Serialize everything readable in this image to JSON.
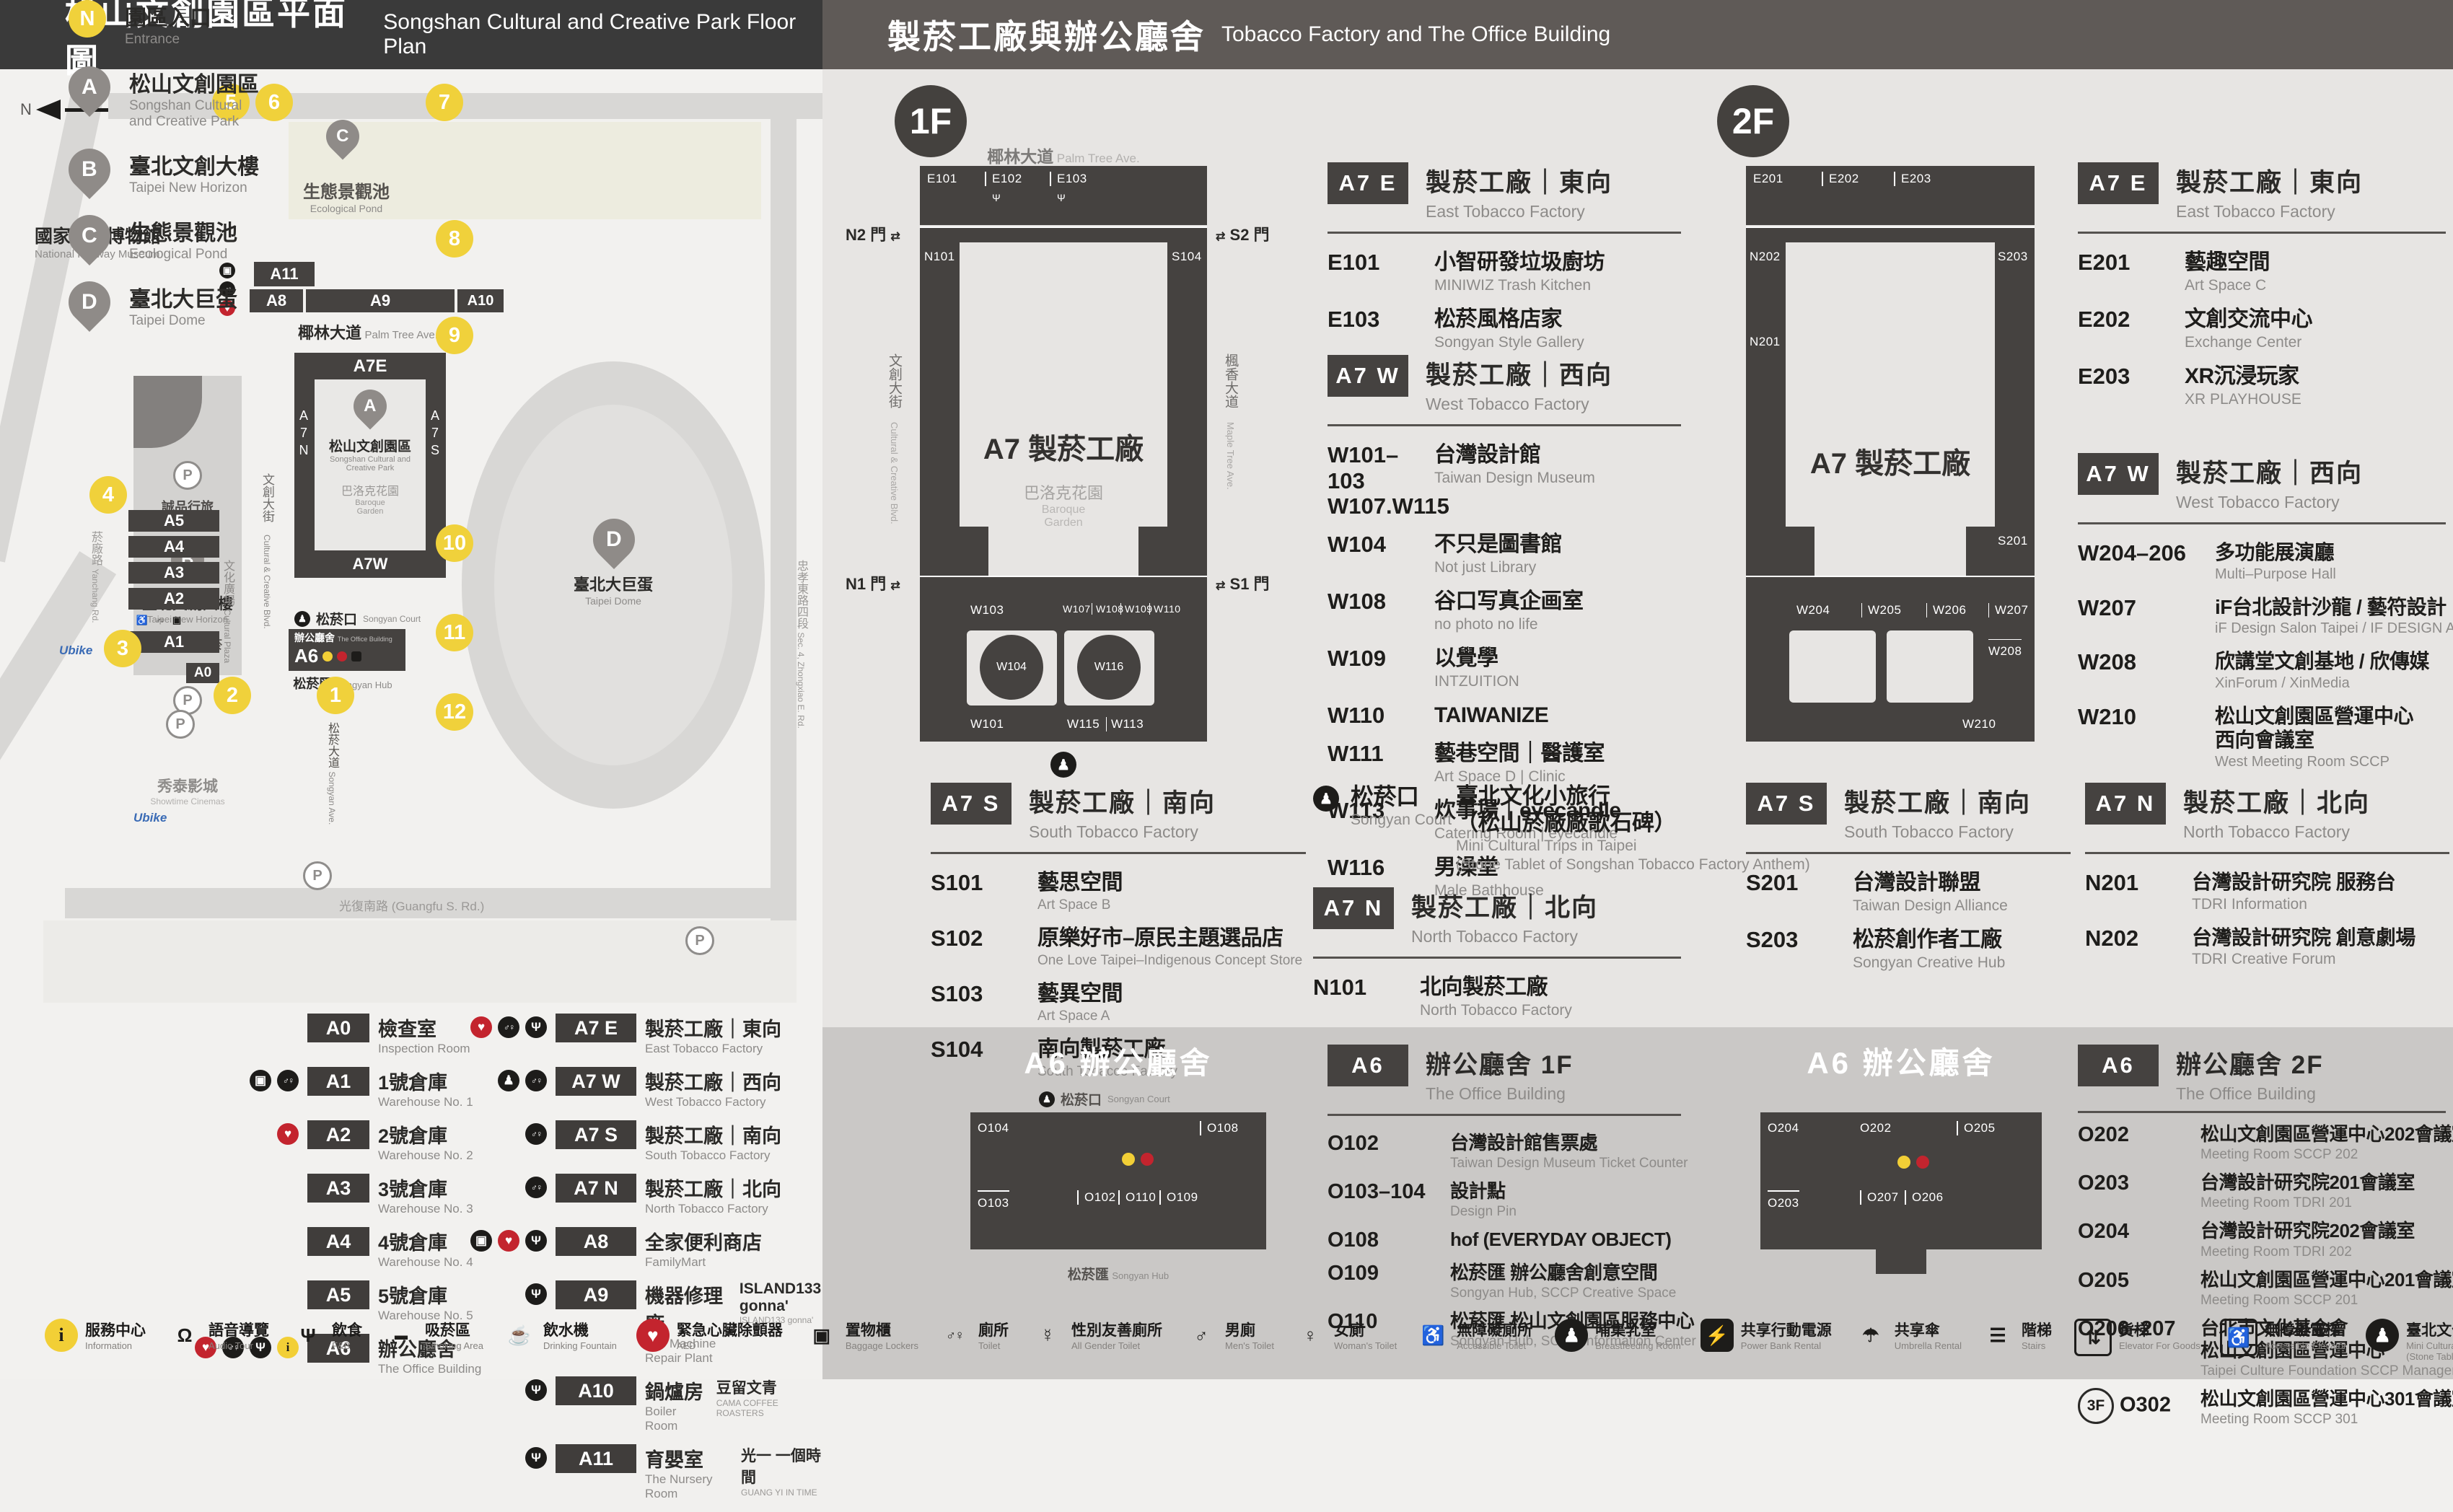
{
  "left": {
    "header": {
      "title_zh": "松山文創園區平面圖",
      "title_en": "Songshan Cultural and Creative Park Floor Plan"
    },
    "map": {
      "north": "N",
      "railway_zh": "國家鐵道博物館",
      "railway_en": "National Railway Museum",
      "pond_pin": "C",
      "pond_zh": "生態景觀池",
      "pond_en": "Ecological Pond",
      "palm_zh": "椰林大道",
      "palm_en": "Palm Tree Ave.",
      "a11": "A11",
      "a8": "A8",
      "a9": "A9",
      "a10": "A10",
      "b_pin": "B",
      "b_zh": "臺北文創大樓",
      "b_en": "Taipei New Horizon",
      "hotel_zh": "誠品行旅",
      "store_zh": "誠品生活松菸",
      "plaza_zh": "文化廣場",
      "plaza_en": "Cultural Plaza",
      "ccb_zh": "文創大街",
      "ccb_en": "Cultural & Creative Blvd.",
      "a7e": "A7E",
      "a7w": "A7W",
      "a7n": "A7N",
      "a7s": "A7S",
      "park_pin": "A",
      "park_zh": "松山文創園區",
      "park_en1": "Songshan Cultural and",
      "park_en2": "Creative Park",
      "baroque_zh": "巴洛克花園",
      "baroque_en1": "Baroque",
      "baroque_en2": "Garden",
      "court_zh": "松菸口",
      "court_en": "Songyan Court",
      "office_zh": "辦公廳舍",
      "office_en": "The Office Building",
      "a6": "A6",
      "hub_zh": "松菸匯",
      "hub_en": "Songyan Hub",
      "dome_pin": "D",
      "dome_zh": "臺北大巨蛋",
      "dome_en": "Taipei Dome",
      "a5": "A5",
      "a4": "A4",
      "a3": "A3",
      "a2": "A2",
      "a1": "A1",
      "a0": "A0",
      "yanchang_zh": "菸廠路",
      "yanchang_en": "Yanchang Rd.",
      "cinema_zh": "秀泰影城",
      "cinema_en": "Showtime Cinemas",
      "songyanave_zh": "松菸大道",
      "songyanave_en": "Songyan Ave.",
      "guangfu": "光復南路 (Guangfu S. Rd.)",
      "zhongxiao_zh": "忠孝東路四段",
      "zhongxiao_en": "Sec. 4, Zhongxiao E. Rd.",
      "ubike": "Ubike",
      "parking": "P",
      "numbers": [
        "1",
        "2",
        "3",
        "4",
        "5",
        "6",
        "7",
        "8",
        "9",
        "10",
        "11",
        "12"
      ]
    },
    "legend_places": [
      {
        "badge": "N",
        "style": "ynum",
        "zh": "園區入口",
        "en1": "Entrance",
        "en2": ""
      },
      {
        "badge": "A",
        "style": "pin",
        "zh": "松山文創園區",
        "en1": "Songshan Cultural",
        "en2": "and Creative Park"
      },
      {
        "badge": "B",
        "style": "pin",
        "zh": "臺北文創大樓",
        "en1": "Taipei New Horizon",
        "en2": ""
      },
      {
        "badge": "C",
        "style": "pin",
        "zh": "生態景觀池",
        "en1": "Ecological Pond",
        "en2": ""
      },
      {
        "badge": "D",
        "style": "pin",
        "zh": "臺北大巨蛋",
        "en1": "Taipei Dome",
        "en2": ""
      }
    ],
    "legend_buildings": [
      {
        "id": "A0",
        "zh": "檢查室",
        "en": "Inspection Room",
        "icons": []
      },
      {
        "id": "A1",
        "zh": "1號倉庫",
        "en": "Warehouse No. 1",
        "icons": [
          "locker-icon",
          "toilet-icon"
        ]
      },
      {
        "id": "A2",
        "zh": "2號倉庫",
        "en": "Warehouse No. 2",
        "icons": [
          "aed-icon"
        ]
      },
      {
        "id": "A3",
        "zh": "3號倉庫",
        "en": "Warehouse No. 3",
        "icons": []
      },
      {
        "id": "A4",
        "zh": "4號倉庫",
        "en": "Warehouse No. 4",
        "icons": []
      },
      {
        "id": "A5",
        "zh": "5號倉庫",
        "en": "Warehouse No. 5",
        "icons": []
      },
      {
        "id": "A6",
        "zh": "辦公廳舍",
        "en": "The Office Building",
        "icons": [
          "aed-icon",
          "toilet-icon",
          "fnb-icon",
          "info-icon"
        ]
      }
    ],
    "legend_factory": [
      {
        "id": "A7 E",
        "zh": "製菸工廠｜東向",
        "en": "East Tobacco Factory",
        "icons": [
          "aed-icon",
          "toilet-icon",
          "fnb-icon"
        ]
      },
      {
        "id": "A7 W",
        "zh": "製菸工廠｜西向",
        "en": "West Tobacco Factory",
        "icons": [
          "breastfeeding-icon",
          "toilet-icon"
        ]
      },
      {
        "id": "A7 S",
        "zh": "製菸工廠｜南向",
        "en": "South Tobacco Factory",
        "icons": [
          "toilet-icon"
        ]
      },
      {
        "id": "A7 N",
        "zh": "製菸工廠｜北向",
        "en": "North Tobacco Factory",
        "icons": [
          "toilet-icon"
        ]
      },
      {
        "id": "A8",
        "zh": "全家便利商店",
        "en": "FamilyMart",
        "icons": [
          "locker-icon",
          "aed-icon",
          "fnb-icon"
        ]
      },
      {
        "id": "A9",
        "zh": "機器修理廠",
        "en": "The Machine Repair Plant",
        "extra_zh": "ISLAND133 gonna'",
        "extra_en": "ISLAND133 gonna'",
        "icons": [
          "fnb-icon"
        ]
      },
      {
        "id": "A10",
        "zh": "鍋爐房",
        "en": "Boiler Room",
        "extra_zh": "豆留文青",
        "extra_en": "CAMA COFFEE ROASTERS",
        "icons": [
          "fnb-icon"
        ]
      },
      {
        "id": "A11",
        "zh": "育嬰室",
        "en": "The Nursery Room",
        "extra_zh": "光一 一個時間",
        "extra_en": "GUANG YI IN TIME",
        "icons": [
          "fnb-icon"
        ]
      }
    ]
  },
  "right": {
    "header": {
      "title_zh": "製菸工廠與辦公廳舍",
      "title_en": "Tobacco Factory and The Office Building"
    },
    "floor1": {
      "label": "1F",
      "plan": {
        "street_top_zh": "椰林大道",
        "street_top_en": "Palm Tree Ave.",
        "e101": "E101",
        "e102": "E102",
        "e103": "E103",
        "n101": "N101",
        "s104": "S104",
        "w101": "W101",
        "w102": "W102",
        "w103": "W103",
        "w104": "W104",
        "w107": "W107",
        "w108": "W108",
        "w109": "W109",
        "w110": "W110",
        "w111": "W111",
        "w113": "W113",
        "w115": "W115",
        "w116": "W116",
        "center": "A7 製菸工廠",
        "garden_zh": "巴洛克花園",
        "garden_en1": "Baroque",
        "garden_en2": "Garden",
        "gate_n2": "N2 門",
        "gate_s2": "S2 門",
        "gate_n1": "N1 門",
        "gate_s1": "S1 門",
        "arrows": "⇄",
        "street_left_zh": "文創大街",
        "street_left_en": "Cultural & Creative Blvd.",
        "street_right_zh": "楓香大道",
        "street_right_en": "Maple Tree Ave."
      },
      "a7e": {
        "badge": "A7 E",
        "zh": "製菸工廠｜東向",
        "en": "East Tobacco Factory",
        "rows": [
          {
            "no": "E101",
            "zh": "小智研發垃圾廚坊",
            "en": "MINIWIZ Trash Kitchen"
          },
          {
            "no": "E103",
            "zh": "松菸風格店家",
            "en": "Songyan Style Gallery",
            "icon": "fnb-icon"
          }
        ]
      },
      "a7w": {
        "badge": "A7 W",
        "zh": "製菸工廠｜西向",
        "en": "West Tobacco Factory",
        "rows": [
          {
            "no": "W101–103",
            "no2": "W107.W115",
            "zh": "台灣設計館",
            "en": "Taiwan Design Museum"
          },
          {
            "no": "W104",
            "zh": "不只是圖書館",
            "en": "Not just Library"
          },
          {
            "no": "W108",
            "zh": "谷口写真企画室",
            "en": "no photo no life"
          },
          {
            "no": "W109",
            "zh": "以覺學",
            "en": "INTZUITION"
          },
          {
            "no": "W110",
            "zh": "TAIWANIZE"
          },
          {
            "no": "W111",
            "zh": "藝巷空間｜醫護室",
            "en": "Art Space D | Clinic"
          },
          {
            "no": "W113",
            "zh": "炊事場｜eyecandle",
            "en": "Catering Room | eyecandle"
          },
          {
            "no": "W116",
            "zh": "男澡堂",
            "en": "Male Bathhouse"
          }
        ]
      },
      "a7s": {
        "badge": "A7 S",
        "zh": "製菸工廠｜南向",
        "en": "South Tobacco Factory",
        "rows": [
          {
            "no": "S101",
            "zh": "藝思空間",
            "en": "Art Space B"
          },
          {
            "no": "S102",
            "zh": "原樂好市–原民主題選品店",
            "en": "One Love Taipei–Indigenous Concept Store"
          },
          {
            "no": "S103",
            "zh": "藝異空間",
            "en": "Art Space A"
          },
          {
            "no": "S104",
            "zh": "南向製菸工廠",
            "en": "South Tobacco Factory"
          }
        ]
      },
      "court": {
        "zh": "松菸口",
        "en": "Songyan Court",
        "t1": "臺北文化小旅行",
        "t2": "（松山菸廠廠歌石碑）",
        "e1": "Mini Cultural Trips in Taipei",
        "e2": "(Stone Tablet of Songshan Tobacco Factory Anthem)"
      },
      "a7n": {
        "badge": "A7 N",
        "zh": "製菸工廠｜北向",
        "en": "North Tobacco Factory",
        "rows": [
          {
            "no": "N101",
            "zh": "北向製菸工廠",
            "en": "North Tobacco Factory"
          }
        ]
      },
      "a6": {
        "badge": "A6",
        "zh": "辦公廳舍 1F",
        "en": "The Office Building",
        "rows": [
          {
            "no": "O102",
            "zh": "台灣設計館售票處",
            "en": "Taiwan Design Museum Ticket Counter"
          },
          {
            "no": "O103–104",
            "zh": "設計點",
            "en": "Design Pin"
          },
          {
            "no": "O108",
            "zh": "hof (EVERYDAY OBJECT)",
            "icon": "fnb-icon"
          },
          {
            "no": "O109",
            "zh": "松菸匯 辦公廳舍創意空間",
            "en": "Songyan Hub, SCCP Creative Space"
          },
          {
            "no": "O110",
            "zh": "松菸匯 松山文創園區服務中心",
            "en": "Songyan Hub, SCCP Information Center"
          }
        ]
      },
      "a6plan": {
        "title": "A6 辦公廳舍",
        "court_zh": "松菸口",
        "court_en": "Songyan Court",
        "hub_zh": "松菸匯",
        "hub_en": "Songyan Hub",
        "o102": "O102",
        "o103": "O103",
        "o104": "O104",
        "o108": "O108",
        "o109": "O109",
        "o110": "O110"
      }
    },
    "floor2": {
      "label": "2F",
      "plan": {
        "e201": "E201",
        "e202": "E202",
        "e203": "E203",
        "n201": "N201",
        "n202": "N202",
        "s201": "S201",
        "s203": "S203",
        "w204": "W204",
        "w205": "W205",
        "w206": "W206",
        "w207": "W207",
        "w208": "W208",
        "w210": "W210",
        "center": "A7 製菸工廠"
      },
      "a7e": {
        "badge": "A7 E",
        "zh": "製菸工廠｜東向",
        "en": "East Tobacco Factory",
        "rows": [
          {
            "no": "E201",
            "zh": "藝趣空間",
            "en": "Art Space C"
          },
          {
            "no": "E202",
            "zh": "文創交流中心",
            "en": "Exchange Center"
          },
          {
            "no": "E203",
            "zh": "XR沉浸玩家",
            "en": "XR PLAYHOUSE"
          }
        ]
      },
      "a7w": {
        "badge": "A7 W",
        "zh": "製菸工廠｜西向",
        "en": "West Tobacco Factory",
        "rows": [
          {
            "no": "W204–206",
            "zh": "多功能展演廳",
            "en": "Multi–Purpose Hall"
          },
          {
            "no": "W207",
            "zh": "iF台北設計沙龍 / 藝符設計",
            "en": "iF Design Salon Taipei / IF DESIGN ASIA"
          },
          {
            "no": "W208",
            "zh": "欣講堂文創基地 / 欣傳媒",
            "en": "XinForum / XinMedia"
          },
          {
            "no": "W210",
            "zh": "松山文創園區營運中心",
            "zh2": "西向會議室",
            "en": "West Meeting Room SCCP"
          }
        ]
      },
      "a7s": {
        "badge": "A7 S",
        "zh": "製菸工廠｜南向",
        "en": "South Tobacco Factory",
        "rows": [
          {
            "no": "S201",
            "zh": "台灣設計聯盟",
            "en": "Taiwan Design Alliance"
          },
          {
            "no": "S203",
            "zh": "松菸創作者工廠",
            "en": "Songyan Creative Hub"
          }
        ]
      },
      "a7n": {
        "badge": "A7 N",
        "zh": "製菸工廠｜北向",
        "en": "North Tobacco Factory",
        "rows": [
          {
            "no": "N201",
            "zh": "台灣設計研究院 服務台",
            "en": "TDRI Information"
          },
          {
            "no": "N202",
            "zh": "台灣設計研究院 創意劇場",
            "en": "TDRI Creative Forum"
          }
        ]
      },
      "a6": {
        "badge": "A6",
        "zh": "辦公廳舍 2F",
        "en": "The Office Building",
        "rows": [
          {
            "no": "O202",
            "zh": "松山文創園區營運中心202會議室",
            "en": "Meeting Room SCCP 202"
          },
          {
            "no": "O203",
            "zh": "台灣設計研究院201會議室",
            "en": "Meeting Room TDRI 201"
          },
          {
            "no": "O204",
            "zh": "台灣設計研究院202會議室",
            "en": "Meeting Room TDRI 202"
          },
          {
            "no": "O205",
            "zh": "松山文創園區營運中心201會議室",
            "en": "Meeting Room SCCP 201"
          },
          {
            "no": "O206–207",
            "zh": "台北市文化基金會",
            "zh2": "松山文創園區營運中心",
            "en": "Taipei Culture Foundation SCCP Management Center"
          },
          {
            "no": "O302",
            "pre": "3F",
            "zh": "松山文創園區營運中心301會議室",
            "en": "Meeting Room SCCP 301"
          }
        ]
      },
      "a6plan": {
        "title": "A6 辦公廳舍",
        "o202": "O202",
        "o203": "O203",
        "o204": "O204",
        "o205": "O205",
        "o206": "O206",
        "o207": "O207"
      }
    }
  },
  "footer": [
    {
      "icon": "info-icon",
      "zh": "服務中心",
      "en": "Information"
    },
    {
      "icon": "audio-icon",
      "zh": "語音導覽",
      "en": "Audio Tour"
    },
    {
      "icon": "fnb-icon",
      "zh": "飲食",
      "en": "F&B"
    },
    {
      "icon": "smoking-icon",
      "zh": "吸菸區",
      "en": "Smoking Area"
    },
    {
      "icon": "water-icon",
      "zh": "飲水機",
      "en": "Drinking Fountain"
    },
    {
      "icon": "aed-icon",
      "zh": "緊急心臟除顫器",
      "en": "AED"
    },
    {
      "icon": "locker-icon",
      "zh": "置物櫃",
      "en": "Baggage Lockers"
    },
    {
      "icon": "toilet-icon",
      "zh": "廁所",
      "en": "Toilet"
    },
    {
      "icon": "all-gender-icon",
      "zh": "性別友善廁所",
      "en": "All Gender Toilet"
    },
    {
      "icon": "mens-icon",
      "zh": "男廁",
      "en": "Men's Toilet"
    },
    {
      "icon": "womens-icon",
      "zh": "女廁",
      "en": "Woman's Toilet"
    },
    {
      "icon": "accessible-icon",
      "zh": "無障礙廁所",
      "en": "Accessible Toilet"
    },
    {
      "icon": "breastfeeding-icon",
      "zh": "哺集乳室",
      "en": "Breastfeeding Room"
    },
    {
      "icon": "power-icon",
      "zh": "共享行動電源",
      "en": "Power Bank Rental"
    },
    {
      "icon": "umbrella-icon",
      "zh": "共享傘",
      "en": "Umbrella Rental"
    },
    {
      "icon": "stairs-icon",
      "zh": "階梯",
      "en": "Stairs"
    },
    {
      "icon": "goods-elevator-icon",
      "zh": "貨梯",
      "en": "Elevator For Goods"
    },
    {
      "icon": "accessible-elevator-icon",
      "zh": "無障礙電梯",
      "en": "Accessible Elevator"
    },
    {
      "icon": "walk-icon",
      "zh": "臺北文化小旅行",
      "zh2": "(松山菸廠廠歌石碑)",
      "en": "Mini Cultural Trips in Taipei",
      "en2": "(Stone Tablet of Songshan Tobacco Factory Anthem)"
    }
  ]
}
